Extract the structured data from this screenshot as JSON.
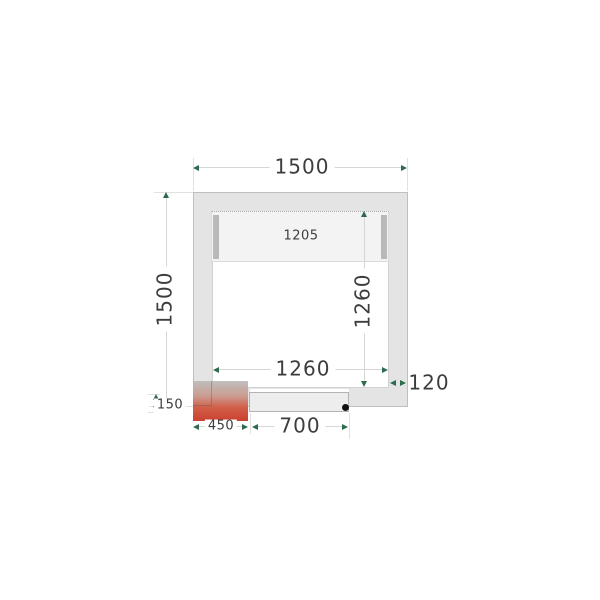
{
  "labels": {
    "outer_width": "1500",
    "outer_depth": "1500",
    "inner_width": "1260",
    "inner_depth": "1260",
    "panel_width": "1205",
    "wall_thickness": "120",
    "unit_width": "450",
    "unit_offset": "150",
    "door_width": "700"
  },
  "colors": {
    "wall_fill": "#e4e4e4",
    "wall_border": "#bfbfbf",
    "interior_fill": "#ffffff",
    "interior_border": "#d2d2d2",
    "shelf_fill": "#f3f3f3",
    "shelf_bar": "#b9b9b9",
    "door_fill": "#ededed",
    "door_border": "#b3b3b3",
    "unit_red": "#cb4130",
    "dim_line": "#d6d6d6",
    "ext_line": "#e1e1e1",
    "arrow": "#2e6b4d",
    "label_text": "#3d3d3d"
  }
}
